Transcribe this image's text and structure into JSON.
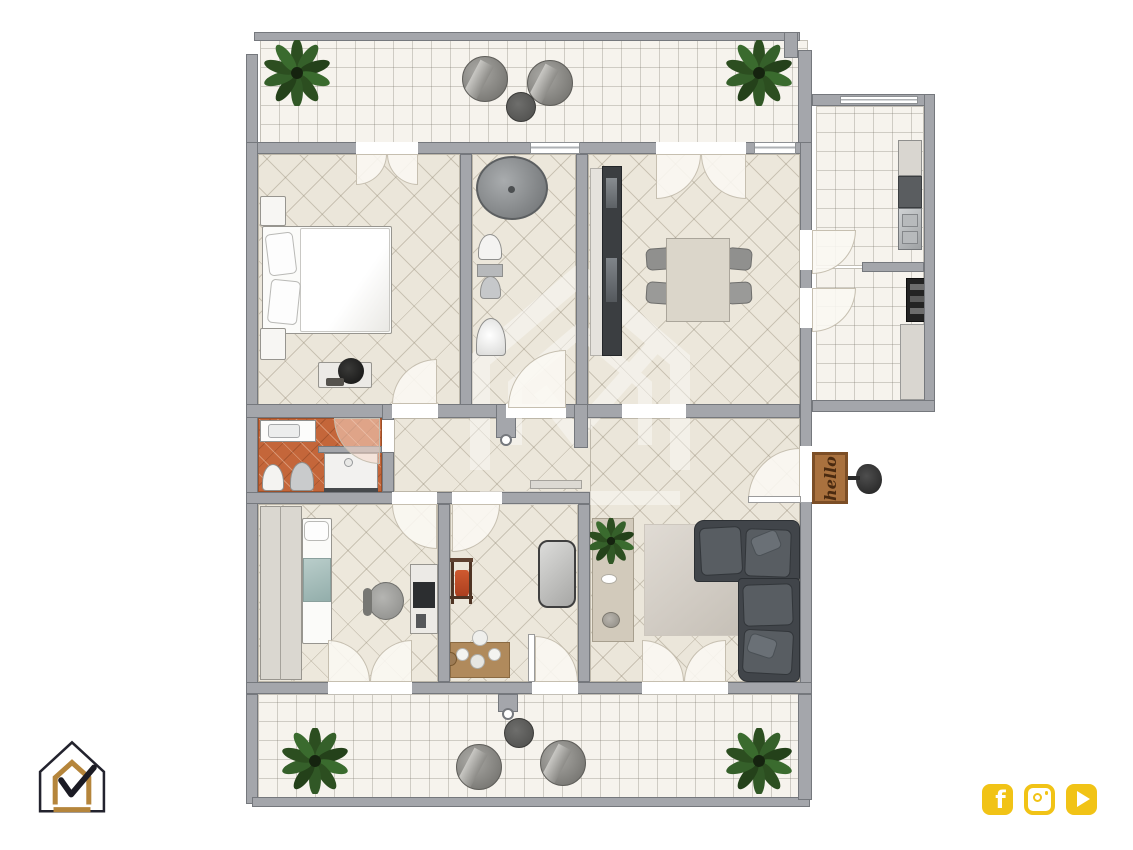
{
  "floorplan": {
    "doormat": {
      "text": "hello"
    },
    "palette": {
      "wall": "#a4a6ab",
      "room_tile": "#ece7db",
      "balcony_tile": "#f6f3ed",
      "bathroom_tile": "#c4663a",
      "sofa": "#41454a",
      "doormat_brown": "#a9713e"
    }
  },
  "branding": {
    "logo": {
      "icon": "house-checkmark-logo",
      "outline_color": "#23232e",
      "gold_color": "#b5853b"
    },
    "social_color": "#f1c316",
    "social_icons": [
      {
        "name": "facebook-icon",
        "glyph": "f"
      },
      {
        "name": "instagram-icon"
      },
      {
        "name": "youtube-icon"
      }
    ]
  }
}
